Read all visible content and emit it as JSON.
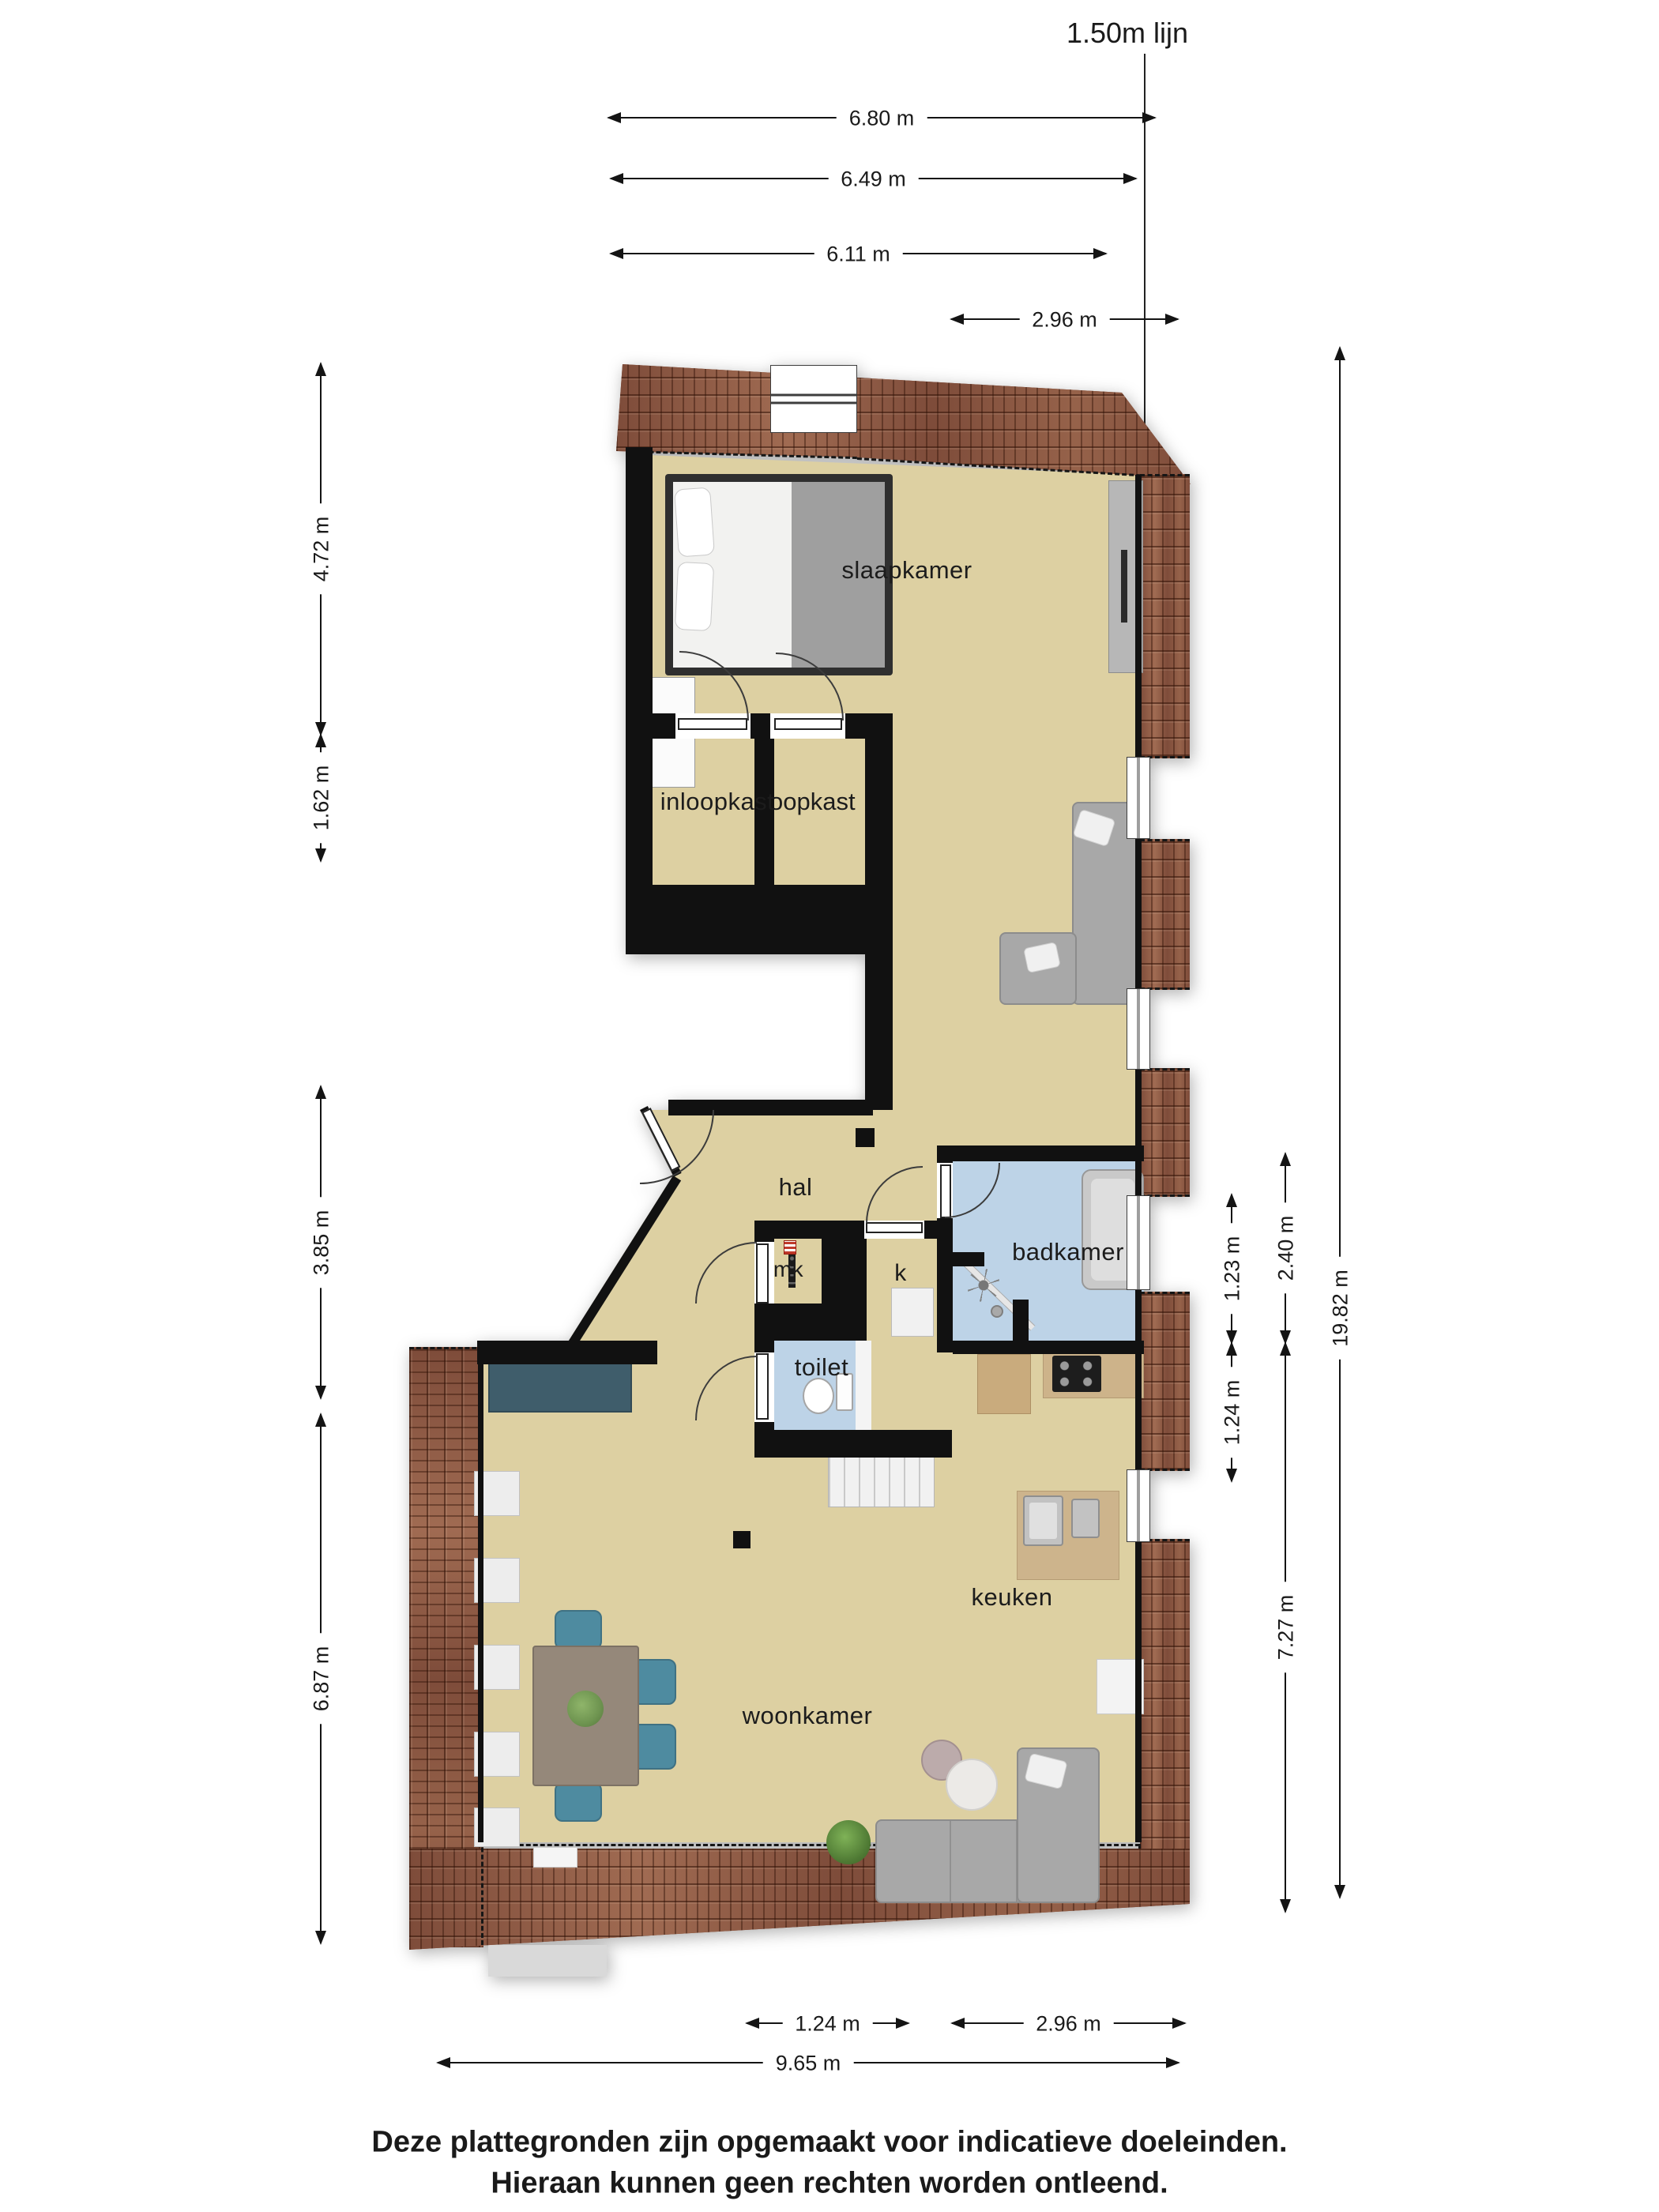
{
  "title": "1.50m lijn",
  "rooms": {
    "slaapkamer": "slaapkamer",
    "inloopkast_left": "inloopkast",
    "inloopkast_right": "inloopkast",
    "hal": "hal",
    "meterkast": "mk",
    "kast": "k",
    "badkamer": "badkamer",
    "toilet": "toilet",
    "keuken": "keuken",
    "woonkamer": "woonkamer"
  },
  "dims": {
    "top": [
      "6.80 m",
      "6.49 m",
      "6.11 m",
      "2.96 m"
    ],
    "left": [
      "4.72 m",
      "1.62 m",
      "3.85 m",
      "6.87 m"
    ],
    "right": [
      "19.82 m",
      "2.40 m",
      "1.23 m",
      "1.24 m",
      "7.27 m"
    ],
    "bottom": [
      "1.24 m",
      "2.96 m",
      "9.65 m"
    ]
  },
  "footer": {
    "line1": "Deze plattegronden zijn opgemaakt voor indicatieve doeleinden.",
    "line2": "Hieraan kunnen geen rechten worden ontleend."
  },
  "colors": {
    "floor": "#ddd0a2",
    "wet_room": "#bdd3e7",
    "wall": "#111111",
    "roof": "#8a5340",
    "wood": "#cdb48c",
    "sofa": "#a8a8a8",
    "chair": "#4e8ba0",
    "sideboard": "#3f5d6b"
  }
}
